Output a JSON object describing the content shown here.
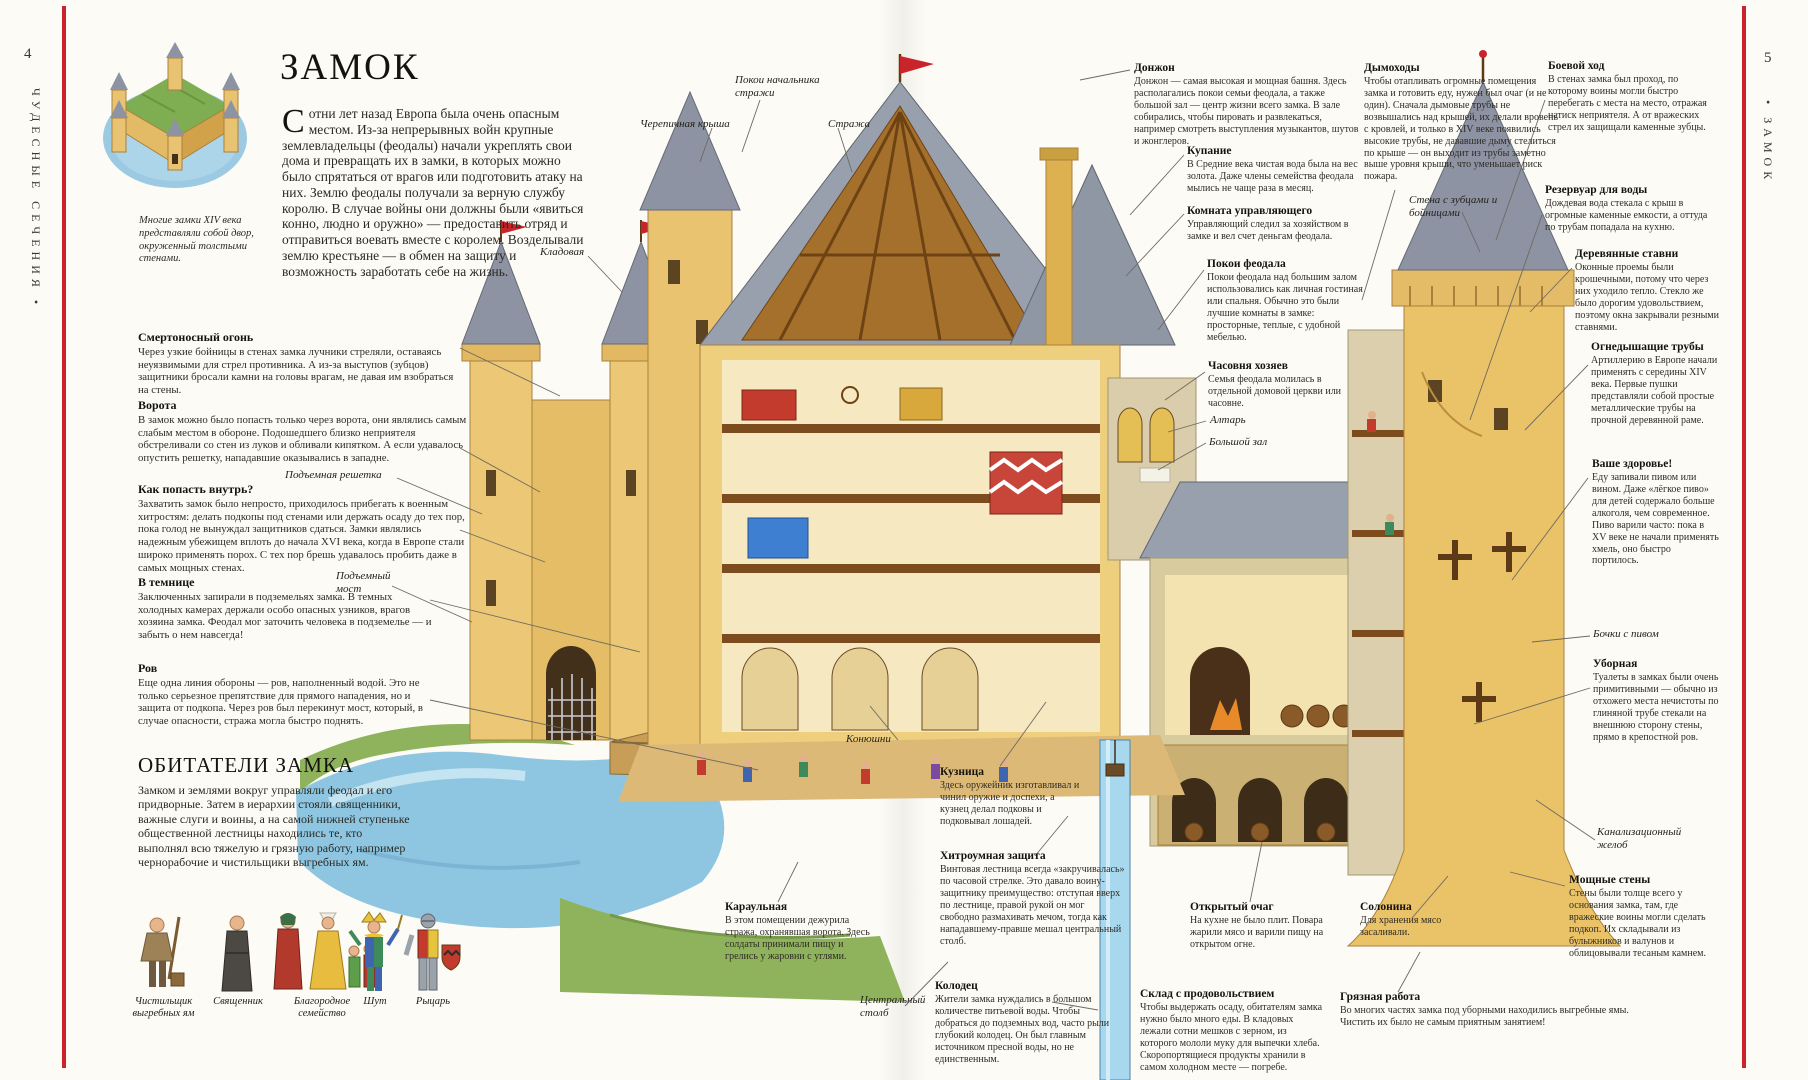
{
  "palette": {
    "accent_red": "#c9242b",
    "paper": "#fcfbf6",
    "stone_tan": "#eac268",
    "roof_grey": "#8d93a2",
    "water_blue": "#8ec6e2",
    "grass_green": "#8fb35c"
  },
  "margins": {
    "left": {
      "page_number": "4",
      "series_title": "ЧУДЕСНЫЕ СЕЧЕНИЯ •"
    },
    "right": {
      "page_number": "5",
      "chapter_title": "• ЗАМОК"
    }
  },
  "left_page": {
    "title": "ЗАМОК",
    "intro_dropcap": "С",
    "intro_rest": "отни лет назад Европа была очень опасным местом. Из-за непрерывных войн крупные землевладельцы (феодалы) начали укреплять свои дома и превращать их в замки, в которых можно было спрятаться от врагов или подготовить атаку на них. Землю феодалы получали за верную службу королю. В случае войны они должны были «явиться конно, людно и оружно» — предоставить отряд и отправиться воевать вместе с королем. Возделывали землю крестьяне — в обмен на защиту и возможность заработать себе на жизнь.",
    "thumbnail_caption": "Многие замки XIV века представляли собой двор, окруженный толстыми стенами.",
    "annotations": [
      {
        "title": "Смертоносный огонь",
        "text": "Через узкие бойницы в стенах замка лучники стреляли, оставаясь неуязвимыми для стрел противника. А из-за выступов (зубцов) защитники бросали камни на головы врагам, не давая им взобраться на стены."
      },
      {
        "title": "Ворота",
        "text": "В замок можно было попасть только через ворота, они являлись самым слабым местом в обороне. Подошедшего близко неприятеля обстреливали со стен из луков и обливали кипятком. А если удавалось опустить решетку, нападавшие оказывались в западне."
      },
      {
        "title": "Как попасть внутрь?",
        "text": "Захватить замок было непросто, приходилось прибегать к военным хитростям: делать подкопы под стенами или держать осаду до тех пор, пока голод не вынуждал защитников сдаться. Замки являлись надежным убежищем вплоть до начала XVI века, когда в Европе стали широко применять порох. С тех пор брешь удавалось пробить даже в самых мощных стенах."
      },
      {
        "title": "В темнице",
        "text": "Заключенных запирали в подземельях замка. В темных холодных камерах держали особо опасных узников, врагов хозяина замка. Феодал мог заточить человека в подземелье — и забыть о нем навсегда!"
      },
      {
        "title": "Ров",
        "text": "Еще одна линия обороны — ров, наполненный водой. Это не только серьезное препятствие для прямого нападения, но и защита от подкопа. Через ров был перекинут мост, который, в случае опасности, стража могла быстро поднять."
      }
    ],
    "inhabitants": {
      "title": "ОБИТАТЕЛИ ЗАМКА",
      "text": "Замком и землями вокруг управляли феодал и его придворные. Затем в иерархии стояли священники, важные слуги и воины, а на самой нижней ступеньке общественной лестницы находились те, кто выполнял всю тяжелую и грязную работу, например чернорабочие и чистильщики выгребных ям.",
      "figures": [
        {
          "label": "Чистильщик выгребных ям"
        },
        {
          "label": "Священник"
        },
        {
          "label": "Благородное семейство"
        },
        {
          "label": "Шут"
        },
        {
          "label": "Рыцарь"
        }
      ]
    }
  },
  "illustration_labels": [
    "Покои начальника стражи",
    "Черепичная крыша",
    "Стража",
    "Кладовая",
    "Подъемная решетка",
    "Подъемный мост",
    "Конюшни",
    "Центральный столб",
    "Стена с зубцами и бойницами",
    "Алтарь",
    "Большой зал",
    "Бочки с пивом",
    "Канализационный желоб"
  ],
  "right_page": {
    "annotations": [
      {
        "title": "Донжон",
        "text": "Донжон — самая высокая и мощная башня. Здесь располагались покои семьи феодала, а также большой зал — центр жизни всего замка. В зале собирались, чтобы пировать и развлекаться, например смотреть выступления музыкантов, шутов и жонглеров."
      },
      {
        "title": "Купание",
        "text": "В Средние века чистая вода была на вес золота. Даже члены семейства феодала мылись не чаще раза в месяц."
      },
      {
        "title": "Комната управляющего",
        "text": "Управляющий следил за хозяйством в замке и вел счет деньгам феодала."
      },
      {
        "title": "Покои феодала",
        "text": "Покои феодала над большим залом использовались как личная гостиная или спальня. Обычно это были лучшие комнаты в замке: просторные, теплые, с удобной мебелью."
      },
      {
        "title": "Часовня хозяев",
        "text": "Семья феодала молилась в отдельной домовой церкви или часовне."
      },
      {
        "title": "Дымоходы",
        "text": "Чтобы отапливать огромные помещения замка и готовить еду, нужен был очаг (и не один). Сначала дымовые трубы не возвышались над крышей, их делали вровень с кровлей, и только в XIV веке появились высокие трубы, не дававшие дыму стелиться по крыше — он выходит из трубы заметно выше уровня крыши, что уменьшает риск пожара."
      },
      {
        "title": "Боевой ход",
        "text": "В стенах замка был проход, по которому воины могли быстро перебегать с места на место, отражая натиск неприятеля. А от вражеских стрел их защищали каменные зубцы."
      },
      {
        "title": "Резервуар для воды",
        "text": "Дождевая вода стекала с крыш в огромные каменные емкости, а оттуда по трубам попадала на кухню."
      },
      {
        "title": "Деревянные ставни",
        "text": "Оконные проемы были крошечными, потому что через них уходило тепло. Стекло же было дорогим удовольствием, поэтому окна закрывали резными ставнями."
      },
      {
        "title": "Огнедышащие трубы",
        "text": "Артиллерию в Европе начали применять с середины XIV века. Первые пушки представляли собой простые металлические трубы на прочной деревянной раме."
      },
      {
        "title": "Ваше здоровье!",
        "text": "Еду запивали пивом или вином. Даже «лёгкое пиво» для детей содержало больше алкоголя, чем современное. Пиво варили часто: пока в XV веке не начали применять хмель, оно быстро портилось."
      },
      {
        "title": "Уборная",
        "text": "Туалеты в замках были очень примитивными — обычно из отхожего места нечистоты по глиняной трубе стекали на внешнюю сторону стены, прямо в крепостной ров."
      },
      {
        "title": "Мощные стены",
        "text": "Стены были толще всего у основания замка, там, где вражеские воины могли сделать подкоп. Их складывали из булыжников и валунов и облицовывали тесаным камнем."
      },
      {
        "title": "Грязная работа",
        "text": "Во многих частях замка под уборными находились выгребные ямы. Чистить их было не самым приятным занятием!"
      },
      {
        "title": "Кузница",
        "text": "Здесь оружейник изготавливал и чинил оружие и доспехи, а кузнец делал подковы и подковывал лошадей."
      },
      {
        "title": "Хитроумная защита",
        "text": "Винтовая лестница всегда «закручивалась» по часовой стрелке. Это давало воину-защитнику преимущество: отступая вверх по лестнице, правой рукой он мог свободно размахивать мечом, тогда как нападавшему-правше мешал центральный столб."
      },
      {
        "title": "Колодец",
        "text": "Жители замка нуждались в большом количестве питьевой воды. Чтобы добраться до подземных вод, часто рыли глубокий колодец. Он был главным источником пресной воды, но не единственным."
      },
      {
        "title": "Открытый очаг",
        "text": "На кухне не было плит. Повара жарили мясо и варили пищу на открытом огне."
      },
      {
        "title": "Солонина",
        "text": "Для хранения мясо засаливали."
      },
      {
        "title": "Склад с продовольствием",
        "text": "Чтобы выдержать осаду, обитателям замка нужно было много еды. В кладовых лежали сотни мешков с зерном, из которого мололи муку для выпечки хлеба. Скоропортящиеся продукты хранили в самом холодном месте — погребе."
      },
      {
        "title": "Караульная",
        "text": "В этом помещении дежурила стража, охранявшая ворота. Здесь солдаты принимали пищу и грелись у жаровни с углями."
      }
    ]
  }
}
